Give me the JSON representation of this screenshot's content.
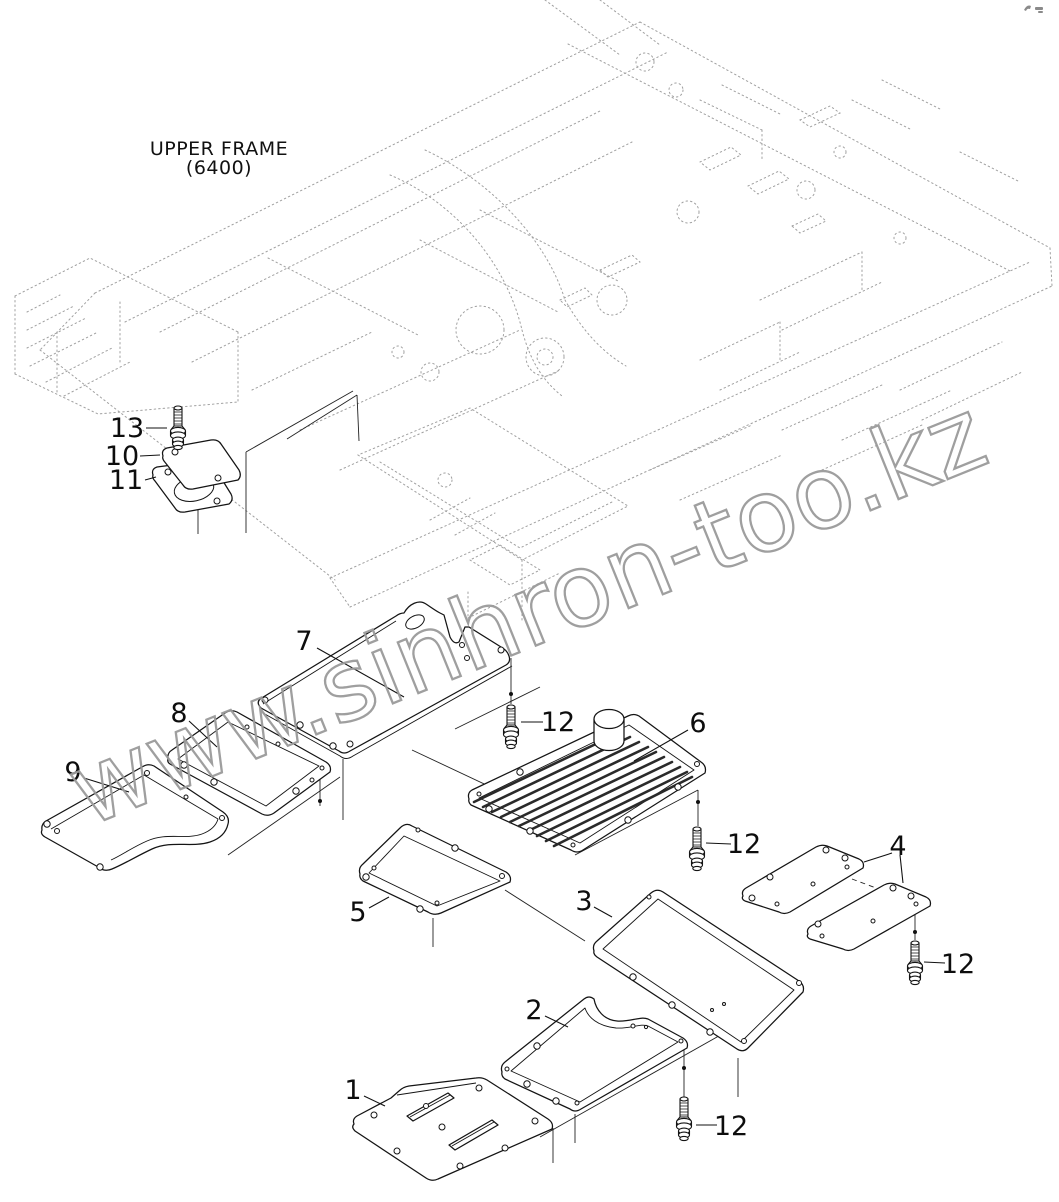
{
  "page": {
    "width": 1059,
    "height": 1202,
    "background": "#ffffff"
  },
  "title_block": {
    "label": "UPPER FRAME",
    "code": "(6400)"
  },
  "watermark": {
    "text": "www.sinhron-too.kz",
    "color": "#9a9a9a",
    "angle_deg": -22
  },
  "colors": {
    "line_art": "#141414",
    "ghost_line": "#a0a0a0",
    "callout_text": "#0d0d0d",
    "background": "#ffffff"
  },
  "callouts": [
    {
      "num": "13"
    },
    {
      "num": "10"
    },
    {
      "num": "11"
    },
    {
      "num": "7"
    },
    {
      "num": "8"
    },
    {
      "num": "9"
    },
    {
      "num": "12"
    },
    {
      "num": "6"
    },
    {
      "num": "12"
    },
    {
      "num": "4"
    },
    {
      "num": "12"
    },
    {
      "num": "5"
    },
    {
      "num": "3"
    },
    {
      "num": "2"
    },
    {
      "num": "12"
    },
    {
      "num": "1"
    }
  ],
  "part_numbers_visible": [
    "1",
    "2",
    "3",
    "4",
    "5",
    "6",
    "7",
    "8",
    "9",
    "10",
    "11",
    "12",
    "13"
  ]
}
